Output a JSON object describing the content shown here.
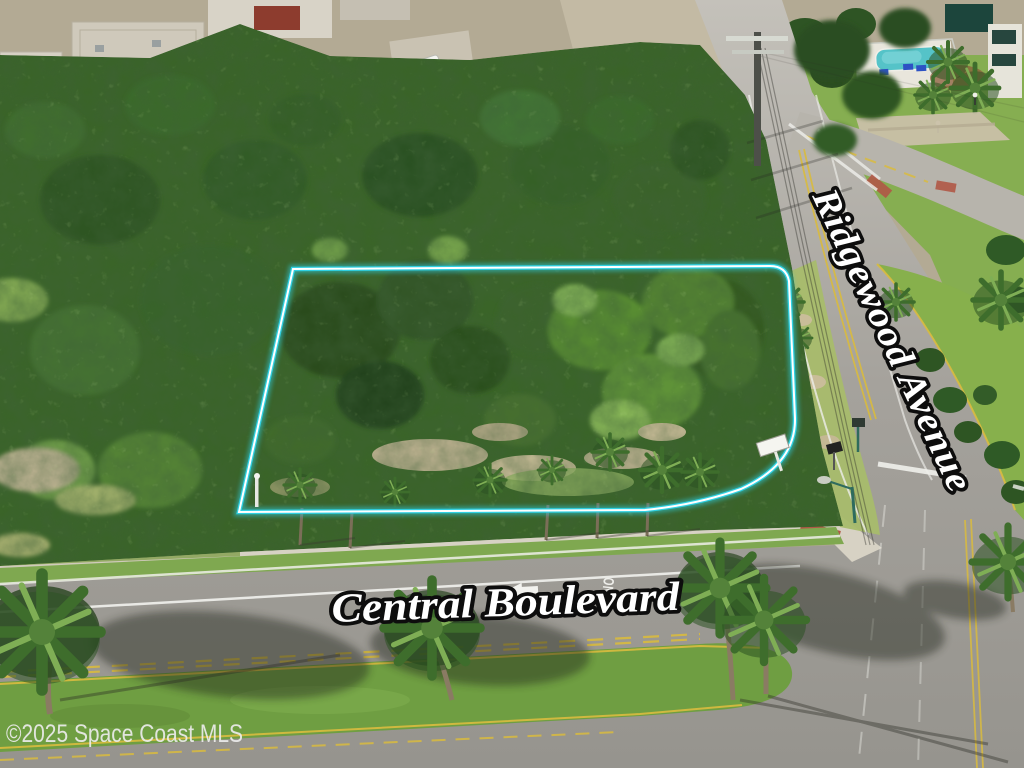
{
  "photo": {
    "kind": "aerial-drone-photo",
    "subject": "vacant wooded corner lot outlined for sale at Ridgewood Avenue and Central Boulevard"
  },
  "street_labels": {
    "diagonal_road": {
      "text": "Ridgewood Avenue",
      "rotation_deg": 65
    },
    "horizontal_road": {
      "text": "Central Boulevard",
      "rotation_deg": -2
    }
  },
  "watermark": {
    "text": "©2025 Space Coast MLS"
  },
  "pavement_markings": {
    "lane_text": "ONLY",
    "turn_arrow": "left-arrow",
    "stop_bar": "white"
  },
  "parcel": {
    "outline_shape": "trapezoid with rounded south-east corner",
    "sign": "small white for-sale sign near east boundary"
  },
  "colors": {
    "parcel_glow": "#2fd3e8",
    "parcel_core": "#ffffff",
    "label_fill": "#ffffff",
    "label_stroke": "#0d0d0d",
    "watermark_fill": "#ececec",
    "canopy": "#3a6428",
    "lawn": "#86ae51",
    "median_grass": "#6f9e42",
    "road": "#a5a29c",
    "yellow_line": "#d9bb3f",
    "pool_water": "#55c3c8",
    "sidewalk": "#d7d2c4",
    "red_tile_roof": "#a04b33",
    "white_roof": "#e7e3d8"
  }
}
